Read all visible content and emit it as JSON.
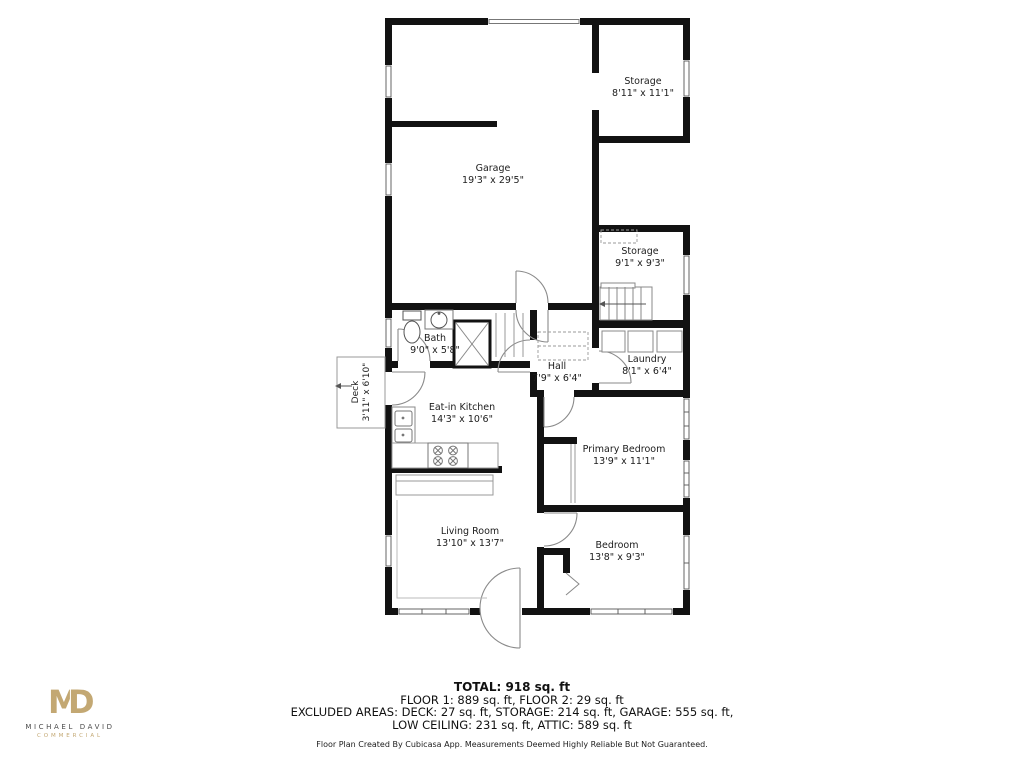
{
  "rooms": [
    {
      "name": "Storage",
      "dims": "8'11\" x 11'1\""
    },
    {
      "name": "Garage",
      "dims": "19'3\" x 29'5\""
    },
    {
      "name": "Storage",
      "dims": "9'1\" x 9'3\""
    },
    {
      "name": "Bath",
      "dims": "9'0\" x 5'8\""
    },
    {
      "name": "Hall",
      "dims": "7'9\" x 6'4\""
    },
    {
      "name": "Laundry",
      "dims": "8'1\" x 6'4\""
    },
    {
      "name": "Deck",
      "dims": "3'11\" x 6'10\""
    },
    {
      "name": "Eat-in Kitchen",
      "dims": "14'3\" x 10'6\""
    },
    {
      "name": "Primary Bedroom",
      "dims": "13'9\" x 11'1\""
    },
    {
      "name": "Living Room",
      "dims": "13'10\" x 13'7\""
    },
    {
      "name": "Bedroom",
      "dims": "13'8\" x 9'3\""
    }
  ],
  "summary": {
    "total": "TOTAL: 918 sq. ft",
    "floors": "FLOOR 1: 889 sq. ft, FLOOR 2: 29 sq. ft",
    "excluded_1": "EXCLUDED AREAS: DECK: 27 sq. ft, STORAGE: 214 sq. ft, GARAGE: 555 sq. ft,",
    "excluded_2": "LOW CEILING: 231 sq. ft, ATTIC: 589 sq. ft",
    "disclaimer": "Floor Plan Created By Cubicasa App. Measurements Deemed Highly Reliable But Not Guaranteed."
  },
  "logo": {
    "monogram_m": "M",
    "monogram_d": "D",
    "name": "MICHAEL DAVID",
    "tagline": "COMMERCIAL",
    "brand_color": "#c3a873"
  }
}
